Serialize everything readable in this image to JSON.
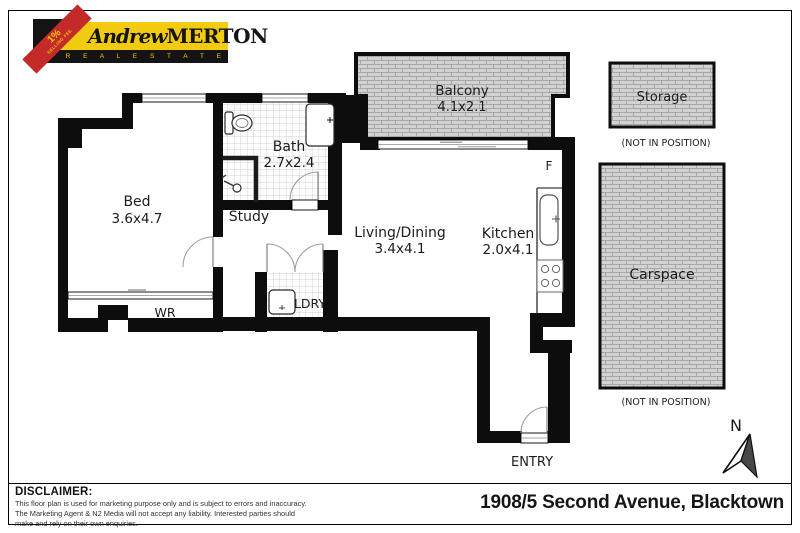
{
  "logo": {
    "ribbon_line1": "1%",
    "ribbon_line2": "SELLING FEE",
    "name_script": "Andrew",
    "name_caps": "MERTON",
    "tagline": "R E A L   E S T A T E",
    "colors": {
      "yellow": "#F2CA10",
      "red": "#C32A28",
      "black": "#141414"
    }
  },
  "rooms": {
    "bed": {
      "name": "Bed",
      "size": "3.6x4.7"
    },
    "bath": {
      "name": "Bath",
      "size": "2.7x2.4"
    },
    "study": {
      "name": "Study"
    },
    "living": {
      "name": "Living/Dining",
      "size": "3.4x4.1"
    },
    "kitchen": {
      "name": "Kitchen",
      "size": "2.0x4.1"
    },
    "balcony": {
      "name": "Balcony",
      "size": "4.1x2.1"
    },
    "laundry": {
      "name": "LDRY"
    },
    "wardrobe": {
      "name": "WR"
    },
    "entry": {
      "name": "ENTRY"
    },
    "fridge": {
      "name": "F"
    }
  },
  "external": {
    "storage": {
      "name": "Storage",
      "note": "(NOT IN POSITION)"
    },
    "carspace": {
      "name": "Carspace",
      "note": "(NOT IN POSITION)"
    }
  },
  "compass": {
    "label": "N"
  },
  "footer": {
    "disclaimer_title": "DISCLAIMER:",
    "disclaimer_lines": [
      "This floor plan is used for marketing purpose only and is subject to errors and inaccuracy.",
      "The Marketing Agent & N2 Media will not accept any liability. Interested parties should",
      "make and rely on their own enquiries."
    ],
    "address": "1908/5 Second Avenue, Blacktown"
  },
  "colors": {
    "wall": "#0d0d0d",
    "hatch_fill": "#d2d2d2",
    "hatch_line": "#9b9b9b",
    "tile_line": "#c6c6c6"
  }
}
